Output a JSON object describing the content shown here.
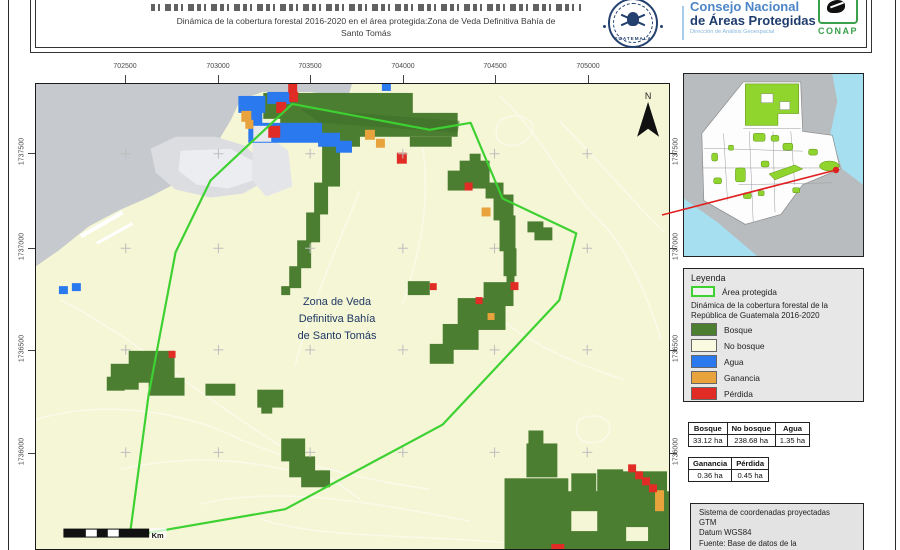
{
  "header": {
    "title_line1": "Dinámica de la cobertura forestal 2016-2020 en el área protegida:Zona de Veda Definitiva Bahía de",
    "title_line2": "Santo Tomás",
    "org": {
      "line1": "Consejo Nacional",
      "line2": "de Áreas Protegidas",
      "line3": "Dirección de Análisis Geoespacial"
    },
    "seal_label": "GUATEMALA",
    "conap_label": "CONAP"
  },
  "map": {
    "xticks": [
      "702500",
      "703000",
      "703500",
      "704000",
      "704500",
      "705000"
    ],
    "yticks": [
      "1737500",
      "1737000",
      "1736500",
      "1736000"
    ],
    "label_line1": "Zona de Veda",
    "label_line2": "Definitiva Bahía",
    "label_line3": "de Santo Tomás",
    "north_label": "N",
    "scale_unit": "Km"
  },
  "legend": {
    "title": "Leyenda",
    "protected_label": "Área protegida",
    "protected_outline_color": "#3ed132",
    "subtitle": "Dinámica de la cobertura forestal de la República de Guatemala 2016-2020",
    "items": [
      {
        "label": "Bosque",
        "color": "#4c7e32"
      },
      {
        "label": "No bosque",
        "color": "#fafae0"
      },
      {
        "label": "Agua",
        "color": "#2b79ef"
      },
      {
        "label": "Ganancia",
        "color": "#e8a33c"
      },
      {
        "label": "Pérdida",
        "color": "#e12b25"
      }
    ]
  },
  "tables": {
    "coverage": {
      "headers": [
        "Bosque",
        "No bosque",
        "Agua"
      ],
      "values": [
        "33.12 ha",
        "238.68 ha",
        "1.35 ha"
      ]
    },
    "change": {
      "headers": [
        "Ganancia",
        "Pérdida"
      ],
      "values": [
        "0.36 ha",
        "0.45 ha"
      ]
    }
  },
  "info_box": {
    "lines": [
      "Sistema de coordenadas proyectadas",
      "GTM",
      "Datum WGS84",
      "Fuente: Base de datos de la",
      "Dirección de Análisis Geoespacial"
    ]
  },
  "colors": {
    "map_background": "#f5f6d6",
    "forest": "#4c7e32",
    "water": "#2b79ef",
    "gain": "#e8a33c",
    "loss": "#e12b25",
    "protected_outline": "#3ed132",
    "sea_gray": "#c6c9cd",
    "inset_water": "#a5dff0",
    "inset_protected": "#90d42e",
    "connector_red": "#e02020"
  }
}
